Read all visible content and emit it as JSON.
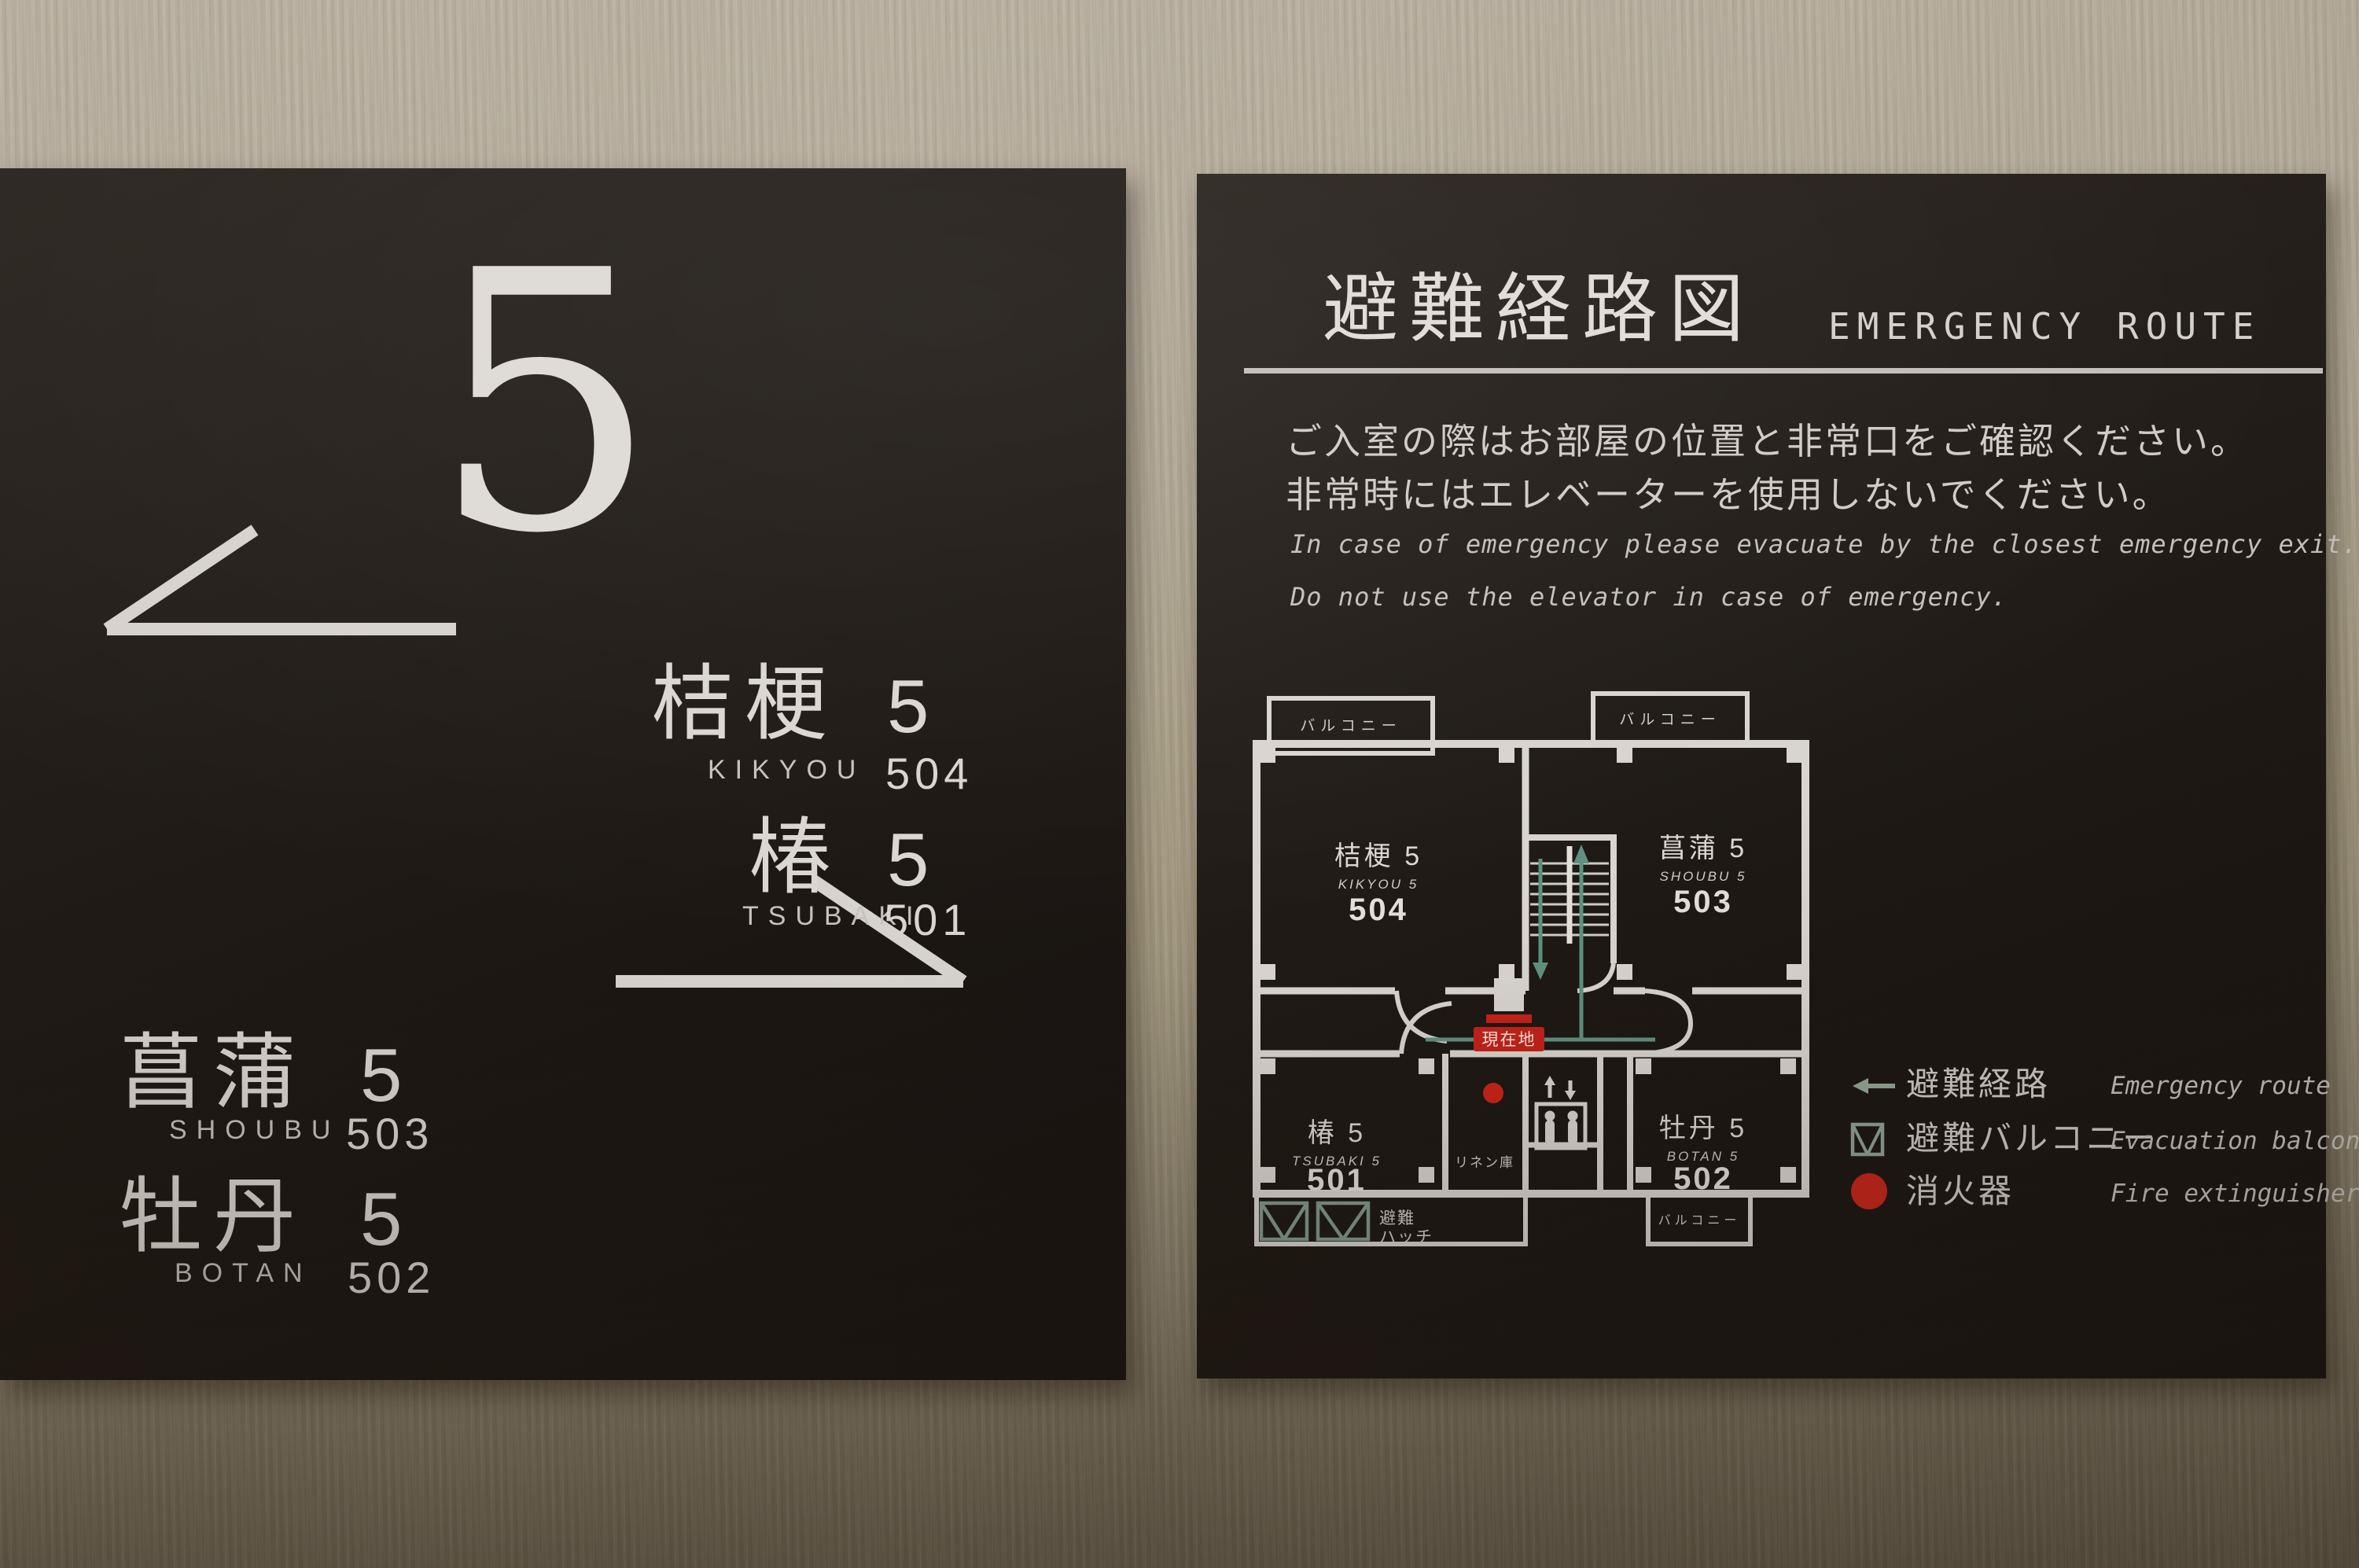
{
  "scene_description": "Photo of two dark hotel wall signs: floor-5 room directory (left) and emergency evacuation route floor plan (right)",
  "left_sign": {
    "floor_number": "5",
    "rooms": [
      {
        "kanji": "桔梗",
        "floor": "5",
        "romaji": "KIKYOU",
        "number": "504"
      },
      {
        "kanji": "椿",
        "floor": "5",
        "romaji": "TSUBAKI",
        "number": "501"
      },
      {
        "kanji": "菖蒲",
        "floor": "5",
        "romaji": "SHOUBU",
        "number": "503"
      },
      {
        "kanji": "牡丹",
        "floor": "5",
        "romaji": "BOTAN",
        "number": "502"
      }
    ]
  },
  "right_sign": {
    "title_jp": "避難経路図",
    "title_en": "EMERGENCY ROUTE",
    "notice": {
      "jp1": "ご入室の際はお部屋の位置と非常口をご確認ください。",
      "jp2": "非常時にはエレベーターを使用しないでください。",
      "en1": "In case of emergency please evacuate by the closest emergency exit.",
      "en2": "Do not use the elevator in case of emergency."
    },
    "plan": {
      "balcony_top_left": "バルコニー",
      "balcony_top_right": "バルコニー",
      "balcony_bottom": "バルコニー",
      "rooms": [
        {
          "kanji": "桔梗 5",
          "romaji": "KIKYOU 5",
          "number": "504"
        },
        {
          "kanji": "菖蒲 5",
          "romaji": "SHOUBU 5",
          "number": "503"
        },
        {
          "kanji": "椿 5",
          "romaji": "TSUBAKI 5",
          "number": "501"
        },
        {
          "kanji": "牡丹 5",
          "romaji": "BOTAN 5",
          "number": "502"
        }
      ],
      "linen_room": "リネン庫",
      "current_location": "現在地",
      "hatch_line1": "避難",
      "hatch_line2": "ハッチ"
    },
    "legend": [
      {
        "jp": "避難経路",
        "en": "Emergency route"
      },
      {
        "jp": "避難バルコニー",
        "en": "Evacuation balcony"
      },
      {
        "jp": "消火器",
        "en": "Fire extinguisher"
      }
    ],
    "colors": {
      "route_teal": "#5e9181",
      "alert_red": "#c42119",
      "sign_background": "#1e1915",
      "sign_text": "#d6d2cd",
      "wall_beige": "#a89e8c"
    }
  }
}
